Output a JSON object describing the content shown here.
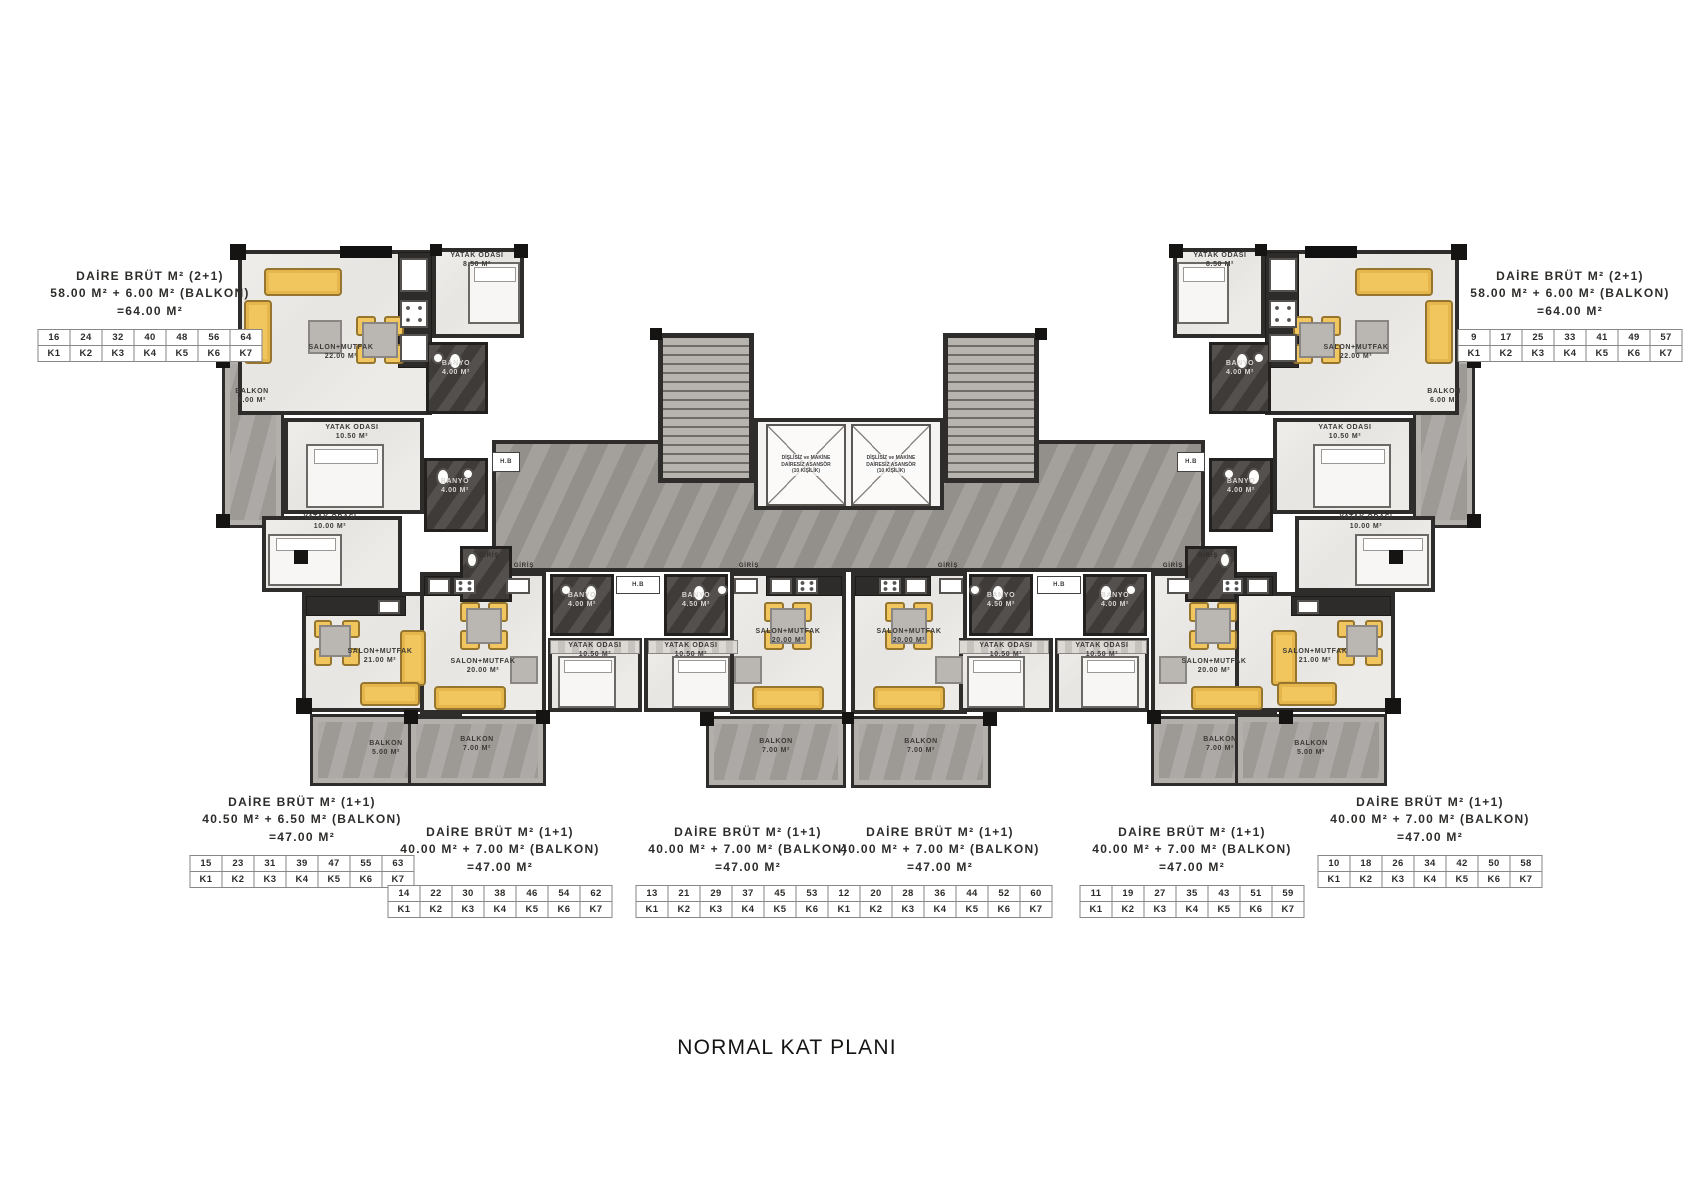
{
  "title": "NORMAL KAT PLANI",
  "colors": {
    "furniture_yellow": "#F1C65E",
    "wall": "#2F2D2B",
    "corridor_gray": "#9C9894",
    "balcony_gray": "#A5A19D",
    "floor_light": "#ECEAE7",
    "bathroom_dark": "#474340"
  },
  "entry_label": "GİRİŞ",
  "shaft_label": "H.B",
  "elevator_lines": [
    "DİŞLİSİZ ve MAKİNE",
    "DAİRESİZ ASANSÖR",
    "(10 KİŞİLİK)"
  ],
  "unit_labels": [
    {
      "id": "top-left",
      "lines": [
        "DAİRE BRÜT M² (2+1)",
        "58.00 M² + 6.00 M² (BALKON)",
        "=64.00 M²"
      ],
      "numbers": [
        "16",
        "24",
        "32",
        "40",
        "48",
        "56",
        "64"
      ],
      "kats": [
        "K1",
        "K2",
        "K3",
        "K4",
        "K5",
        "K6",
        "K7"
      ]
    },
    {
      "id": "top-right",
      "lines": [
        "DAİRE BRÜT M² (2+1)",
        "58.00 M² + 6.00 M² (BALKON)",
        "=64.00 M²"
      ],
      "numbers": [
        "9",
        "17",
        "25",
        "33",
        "41",
        "49",
        "57"
      ],
      "kats": [
        "K1",
        "K2",
        "K3",
        "K4",
        "K5",
        "K6",
        "K7"
      ]
    },
    {
      "id": "bottom-far-left",
      "lines": [
        "DAİRE BRÜT M² (1+1)",
        "40.50 M² + 6.50 M² (BALKON)",
        "=47.00 M²"
      ],
      "numbers": [
        "15",
        "23",
        "31",
        "39",
        "47",
        "55",
        "63"
      ],
      "kats": [
        "K1",
        "K2",
        "K3",
        "K4",
        "K5",
        "K6",
        "K7"
      ]
    },
    {
      "id": "bottom-left-mid",
      "lines": [
        "DAİRE BRÜT M² (1+1)",
        "40.00 M² + 7.00 M² (BALKON)",
        "=47.00 M²"
      ],
      "numbers": [
        "14",
        "22",
        "30",
        "38",
        "46",
        "54",
        "62"
      ],
      "kats": [
        "K1",
        "K2",
        "K3",
        "K4",
        "K5",
        "K6",
        "K7"
      ]
    },
    {
      "id": "bottom-center-left",
      "lines": [
        "DAİRE BRÜT M² (1+1)",
        "40.00 M² + 7.00 M² (BALKON)",
        "=47.00 M²"
      ],
      "numbers": [
        "13",
        "21",
        "29",
        "37",
        "45",
        "53",
        "61"
      ],
      "kats": [
        "K1",
        "K2",
        "K3",
        "K4",
        "K5",
        "K6",
        "K7"
      ]
    },
    {
      "id": "bottom-center-right",
      "lines": [
        "DAİRE BRÜT M² (1+1)",
        "40.00 M² + 7.00 M² (BALKON)",
        "=47.00 M²"
      ],
      "numbers": [
        "12",
        "20",
        "28",
        "36",
        "44",
        "52",
        "60"
      ],
      "kats": [
        "K1",
        "K2",
        "K3",
        "K4",
        "K5",
        "K6",
        "K7"
      ]
    },
    {
      "id": "bottom-right-mid",
      "lines": [
        "DAİRE BRÜT M² (1+1)",
        "40.00 M² + 7.00 M² (BALKON)",
        "=47.00 M²"
      ],
      "numbers": [
        "11",
        "19",
        "27",
        "35",
        "43",
        "51",
        "59"
      ],
      "kats": [
        "K1",
        "K2",
        "K3",
        "K4",
        "K5",
        "K6",
        "K7"
      ]
    },
    {
      "id": "bottom-far-right",
      "lines": [
        "DAİRE BRÜT M² (1+1)",
        "40.00 M² + 7.00 M² (BALKON)",
        "=47.00 M²"
      ],
      "numbers": [
        "10",
        "18",
        "26",
        "34",
        "42",
        "50",
        "58"
      ],
      "kats": [
        "K1",
        "K2",
        "K3",
        "K4",
        "K5",
        "K6",
        "K7"
      ]
    }
  ],
  "room_labels": [
    {
      "name": "YATAK ODASI",
      "area": "8.50 M²"
    },
    {
      "name": "SALON+MUTFAK",
      "area": "22.00 M²"
    },
    {
      "name": "BALKON",
      "area": "6.00 M²"
    },
    {
      "name": "YATAK ODASI",
      "area": "10.50 M²"
    },
    {
      "name": "BANYO",
      "area": "4.00 M²"
    },
    {
      "name": "BANYO",
      "area": "4.00 M²"
    },
    {
      "name": "YATAK ODASI",
      "area": "10.00 M²"
    },
    {
      "name": "YATAK ODASI",
      "area": "8.50 M²"
    },
    {
      "name": "SALON+MUTFAK",
      "area": "22.00 M²"
    },
    {
      "name": "BALKON",
      "area": "6.00 M²"
    },
    {
      "name": "YATAK ODASI",
      "area": "10.50 M²"
    },
    {
      "name": "BANYO",
      "area": "4.00 M²"
    },
    {
      "name": "BANYO",
      "area": "4.00 M²"
    },
    {
      "name": "YATAK ODASI",
      "area": "10.00 M²"
    },
    {
      "name": "SALON+MUTFAK",
      "area": "21.00 M²"
    },
    {
      "name": "BALKON",
      "area": "5.00 M²"
    },
    {
      "name": "SALON+MUTFAK",
      "area": "20.00 M²"
    },
    {
      "name": "BANYO",
      "area": "4.00 M²"
    },
    {
      "name": "YATAK ODASI",
      "area": "10.50 M²"
    },
    {
      "name": "BALKON",
      "area": "7.00 M²"
    },
    {
      "name": "YATAK ODASI",
      "area": "10.50 M²"
    },
    {
      "name": "BANYO",
      "area": "4.50 M²"
    },
    {
      "name": "SALON+MUTFAK",
      "area": "20.00 M²"
    },
    {
      "name": "BALKON",
      "area": "7.00 M²"
    },
    {
      "name": "SALON+MUTFAK",
      "area": "20.00 M²"
    },
    {
      "name": "BANYO",
      "area": "4.50 M²"
    },
    {
      "name": "YATAK ODASI",
      "area": "10.50 M²"
    },
    {
      "name": "BALKON",
      "area": "7.00 M²"
    },
    {
      "name": "YATAK ODASI",
      "area": "10.50 M²"
    },
    {
      "name": "BANYO",
      "area": "4.00 M²"
    },
    {
      "name": "SALON+MUTFAK",
      "area": "20.00 M²"
    },
    {
      "name": "BALKON",
      "area": "7.00 M²"
    },
    {
      "name": "SALON+MUTFAK",
      "area": "21.00 M²"
    },
    {
      "name": "BALKON",
      "area": "5.00 M²"
    }
  ]
}
